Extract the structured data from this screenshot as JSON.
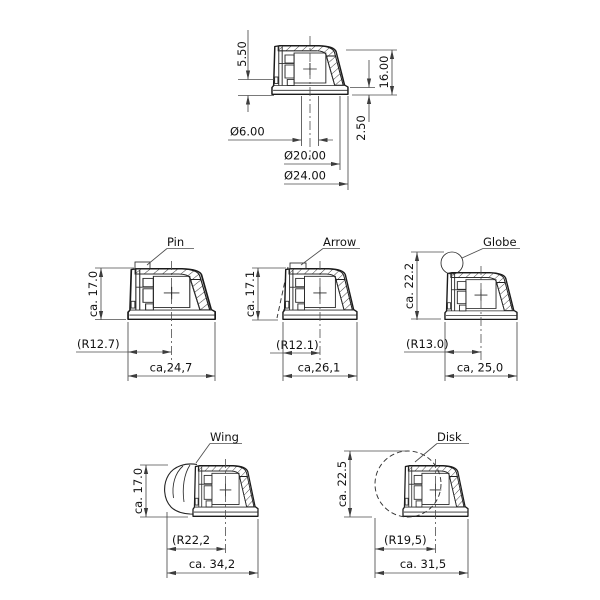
{
  "colors": {
    "ink": "#1a1a1a",
    "dim_ink": "#4d4d4d",
    "background": "#ffffff"
  },
  "top_view": {
    "dims": {
      "boss_height": "5.50",
      "total_height": "16.00",
      "skirt_height": "2.50",
      "shaft_dia": "Ø6.00",
      "inner_dia": "Ø20.00",
      "outer_dia": "Ø24.00"
    }
  },
  "variants": [
    {
      "label": "Pin",
      "height": "ca. 17.0",
      "radius": "(R12.7)",
      "width": "ca,24,7"
    },
    {
      "label": "Arrow",
      "height": "ca. 17.1",
      "radius": "(R12.1)",
      "width": "ca,26,1"
    },
    {
      "label": "Globe",
      "height": "ca. 22.2",
      "radius": "(R13.0)",
      "width": "ca, 25,0"
    },
    {
      "label": "Wing",
      "height": "ca. 17.0",
      "radius": "(R22,2",
      "width": "ca. 34,2"
    },
    {
      "label": "Disk",
      "height": "ca. 22.5",
      "radius": "(R19,5)",
      "width": "ca. 31,5"
    }
  ]
}
